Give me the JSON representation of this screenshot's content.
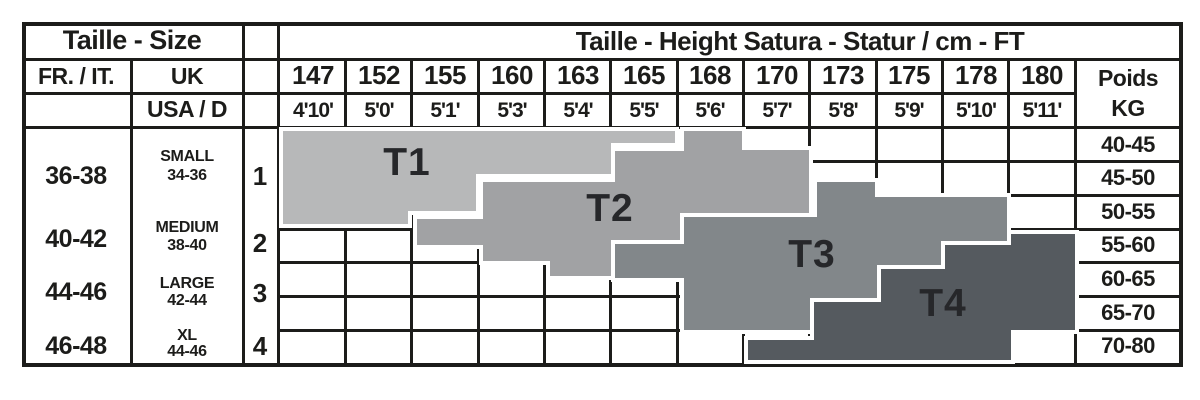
{
  "titles": {
    "left": "Taille - Size",
    "right": "Taille - Height Satura - Statur / cm - FT"
  },
  "headers": {
    "fr_it": "FR. / IT.",
    "uk": "UK",
    "usa_d": "USA / D",
    "poids_line1": "Poids",
    "poids_line2": "KG"
  },
  "heights_cm": [
    "147",
    "152",
    "155",
    "160",
    "163",
    "165",
    "168",
    "170",
    "173",
    "175",
    "178",
    "180"
  ],
  "heights_ft": [
    "4'10'",
    "5'0'",
    "5'1'",
    "5'3'",
    "5'4'",
    "5'5'",
    "5'6'",
    "5'7'",
    "5'8'",
    "5'9'",
    "5'10'",
    "5'11'"
  ],
  "weights_kg": [
    "40-45",
    "45-50",
    "50-55",
    "55-60",
    "60-65",
    "65-70",
    "70-80"
  ],
  "sizes": [
    {
      "fr_it": "36-38",
      "uk_label": "SMALL",
      "uk_range": "34-36",
      "usa_d": "1"
    },
    {
      "fr_it": "40-42",
      "uk_label": "MEDIUM",
      "uk_range": "38-40",
      "usa_d": "2"
    },
    {
      "fr_it": "44-46",
      "uk_label": "LARGE",
      "uk_range": "42-44",
      "usa_d": "3"
    },
    {
      "fr_it": "46-48",
      "uk_label": "XL",
      "uk_range": "44-46",
      "usa_d": "4"
    }
  ],
  "zones": [
    {
      "label": "T1",
      "color": "#b7b8b9"
    },
    {
      "label": "T2",
      "color": "#a1a2a4"
    },
    {
      "label": "T3",
      "color": "#82878a"
    },
    {
      "label": "T4",
      "color": "#555a5f"
    }
  ],
  "colors": {
    "line": "#1c1c1a",
    "background": "#ffffff",
    "zone_gap": "#ffffff",
    "zone_label": "#26272a"
  },
  "chart_data": {
    "type": "table",
    "title": "Taille - Height Satura - Statur / cm - FT",
    "subtitle_left": "Taille - Size",
    "x_categories_height_cm": [
      147,
      152,
      155,
      160,
      163,
      165,
      168,
      170,
      173,
      175,
      178,
      180
    ],
    "x_categories_height_ft": [
      "4'10'",
      "5'0'",
      "5'1'",
      "5'3'",
      "5'4'",
      "5'5'",
      "5'6'",
      "5'7'",
      "5'8'",
      "5'9'",
      "5'10'",
      "5'11'"
    ],
    "y_categories_weight_kg": [
      "40-45",
      "45-50",
      "50-55",
      "55-60",
      "60-65",
      "65-70",
      "70-80"
    ],
    "size_rows": [
      {
        "fr_it": "36-38",
        "uk": "SMALL 34-36",
        "usa_d": "1"
      },
      {
        "fr_it": "40-42",
        "uk": "MEDIUM 38-40",
        "usa_d": "2"
      },
      {
        "fr_it": "44-46",
        "uk": "LARGE 42-44",
        "usa_d": "3"
      },
      {
        "fr_it": "46-48",
        "uk": "XL 44-46",
        "usa_d": "4"
      }
    ],
    "zones": [
      {
        "label": "T1",
        "height_range_cm": [
          147,
          165
        ],
        "weight_range_kg": [
          40,
          55
        ],
        "shape": "staircase band, upper-left"
      },
      {
        "label": "T2",
        "height_range_cm": [
          155,
          170
        ],
        "weight_range_kg": [
          40,
          65
        ],
        "shape": "staircase band, overlaps T1 lower-right"
      },
      {
        "label": "T3",
        "height_range_cm": [
          165,
          178
        ],
        "weight_range_kg": [
          45,
          70
        ],
        "shape": "staircase band, overlaps T2 lower-right"
      },
      {
        "label": "T4",
        "height_range_cm": [
          170,
          180
        ],
        "weight_range_kg": [
          55,
          80
        ],
        "shape": "staircase band, lower-right"
      }
    ],
    "grid": true,
    "legend_position": "none"
  }
}
